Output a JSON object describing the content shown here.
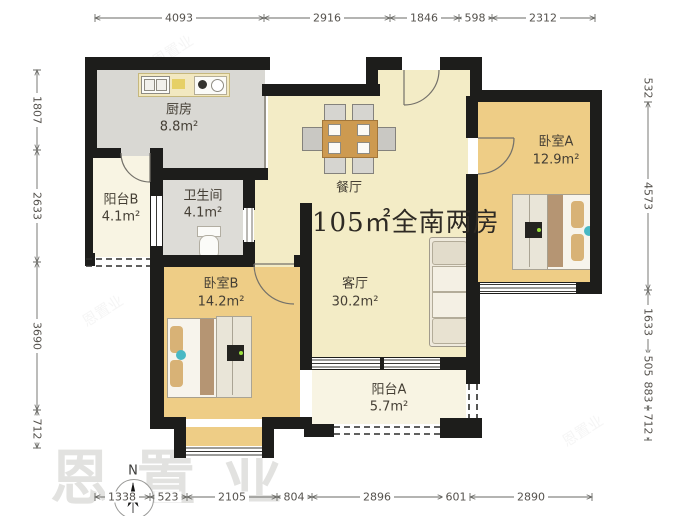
{
  "title": "105㎡全南两房",
  "compass": {
    "label": "N"
  },
  "watermark": {
    "text": "恩置业"
  },
  "rooms": {
    "kitchen": {
      "name": "厨房",
      "area": "8.8m²"
    },
    "balcony_b": {
      "name": "阳台B",
      "area": "4.1m²"
    },
    "bathroom": {
      "name": "卫生间",
      "area": "4.1m²"
    },
    "dining": {
      "name": "餐厅",
      "area": ""
    },
    "bedroom_a": {
      "name": "卧室A",
      "area": "12.9m²"
    },
    "bedroom_b": {
      "name": "卧室B",
      "area": "14.2m²"
    },
    "living": {
      "name": "客厅",
      "area": "30.2m²"
    },
    "balcony_a": {
      "name": "阳台A",
      "area": "5.7m²"
    }
  },
  "dimensions": {
    "top": [
      "4093",
      "2916",
      "1846",
      "598",
      "2312"
    ],
    "bottom": [
      "1338",
      "523",
      "2105",
      "804",
      "2896",
      "601",
      "2890"
    ],
    "left": [
      "1807",
      "2633",
      "3690",
      "712"
    ],
    "right": [
      "532",
      "4573",
      "1633",
      "505",
      "883",
      "712"
    ]
  }
}
